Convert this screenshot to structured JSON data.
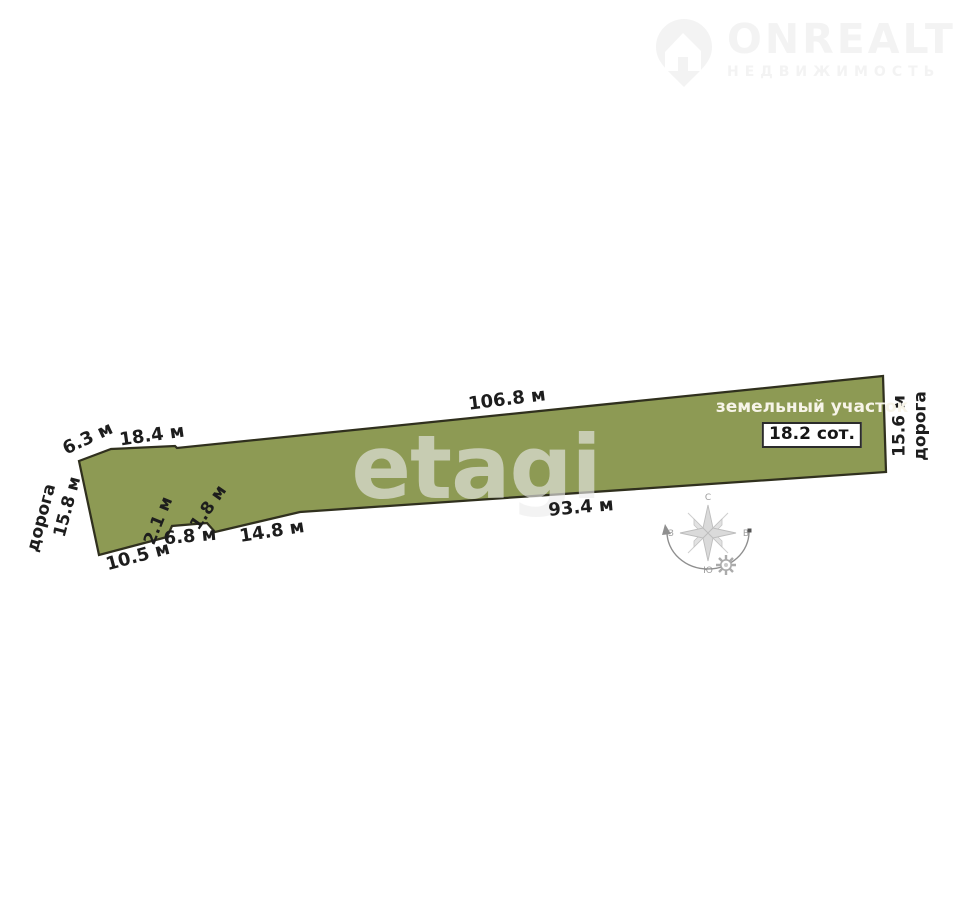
{
  "brand": {
    "name": "ONREALT",
    "tagline": "НЕДВИЖИМОСТЬ",
    "color": "#f3f3f3"
  },
  "watermark": {
    "text": "etagi"
  },
  "plot": {
    "title": "земельный участок",
    "area": "18.2 сот.",
    "fill_color": "#8d9a54",
    "outline_color": "#30301e"
  },
  "measurements": {
    "top_edge_small": "6.3 м",
    "top_edge_mid": "18.4 м",
    "top_edge_long": "106.8 м",
    "left_road": "дорога",
    "left_width": "15.8 м",
    "bottom_left": "10.5 м",
    "notch_up": "2.1 м",
    "notch_top": "6.8 м",
    "notch_down": "1.8 м",
    "bottom_mid": "14.8 м",
    "bottom_long": "93.4 м",
    "right_width": "15.6 м",
    "right_road": "дорога"
  },
  "compass": {
    "north": "С",
    "south": "Ю",
    "west": "З",
    "east": "В"
  }
}
